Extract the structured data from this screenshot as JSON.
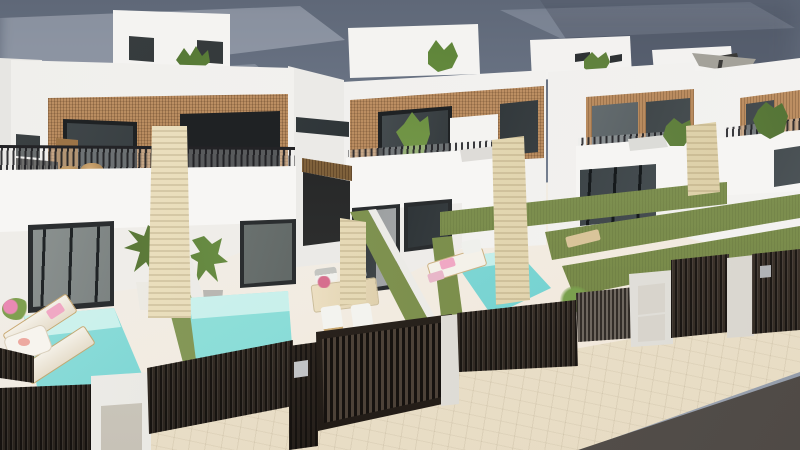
{
  "scene": {
    "type": "3d-architectural-render",
    "subject": "Row of modern white semi-detached villas with private pools and dark slatted street fences",
    "sky": "overcast blue-grey with soft clouds",
    "counts": {
      "houses_visible": 4,
      "pools_visible": 3,
      "rooftop_umbrellas": 1,
      "sun_loungers": 4
    },
    "objects": [
      "white-villa",
      "rooftop-parapet-box",
      "wood-slat-facade-band",
      "dark-framed-window",
      "balcony-railing",
      "travertine-pillar",
      "rooftop-plant",
      "cantilever-umbrella",
      "turquoise-pool",
      "artificial-grass-strip",
      "sun-lounger",
      "pink-towel",
      "outdoor-dining-table",
      "dining-chair",
      "potted-palm",
      "dark-slatted-fence",
      "entrance-gate",
      "white-gate-pillar",
      "utility-door",
      "letterbox-plaque",
      "beige-paver-sidewalk",
      "asphalt-road",
      "green-field-horizon"
    ]
  },
  "palette": {
    "sky_top": "#5f6878",
    "sky_horizon": "#99a1ae",
    "cloud": "#ced3dd",
    "wall_white": "#f4f3f1",
    "wall_side": "#e7e6e3",
    "wood_light": "#c29468",
    "wood_dark": "#a47a4c",
    "window_frame": "#1f2224",
    "glass_dark": "#2f3538",
    "glass_reflection": "#b9bfbc",
    "railing": "#232326",
    "travertine": "#e6dab6",
    "pool_shallow": "#bdeee8",
    "pool_deep": "#55c2c4",
    "grass": "#81954f",
    "field": "#7b8c55",
    "fence_dark": "#352c25",
    "fence_slat": "#16120f",
    "pillar_white": "#efeeea",
    "panel_grey": "#d8d4cc",
    "pavement": "#e9dfc9",
    "road": "#59544f",
    "towel_pink": "#f0a8c4",
    "cushion_grey": "#c4c5c1",
    "table_beige": "#ecdfc2",
    "wicker_tan": "#c49a66"
  }
}
